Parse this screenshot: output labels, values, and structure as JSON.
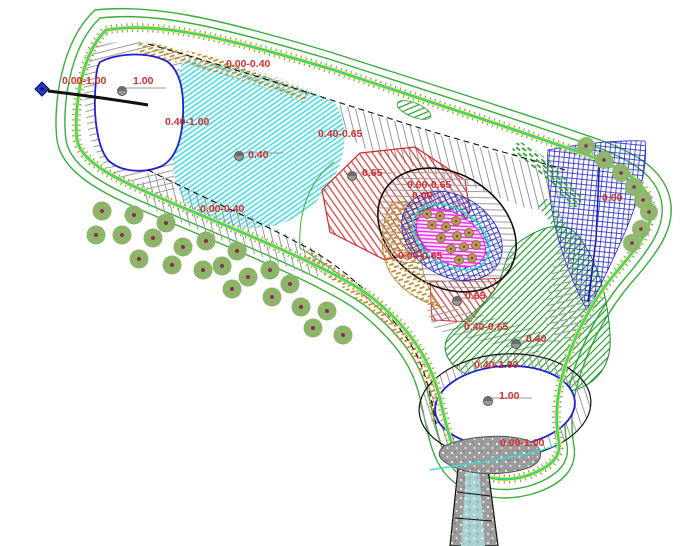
{
  "drawing": {
    "kind": "pond-landscape-plan",
    "colors": {
      "label_red": "#d23030",
      "boundary_green": "#3aae3a",
      "walk_yellow": "#f2ef3a",
      "walk_green": "#3cc43c",
      "walk_cyan": "#35dce0",
      "tick_grey": "#8a8a8a",
      "pond_blue": "#2020cc",
      "shore_black": "#111111",
      "cyan_hatch": "#3ed2da",
      "grey_hatch": "#9a9a9a",
      "red_hatch": "#d42a2a",
      "green_hatch": "#21a12e",
      "blue_cross": "#2329c9",
      "magenta_hatch": "#ea1dea",
      "tan_band": "#c08a28",
      "tree_fill": "#8db469",
      "tree_dot": "#8b2a52",
      "plant_fill": "#b89a58",
      "plant_edge": "#8a7340",
      "plant_dot": "#a22a4a",
      "marker_grey": "#999999",
      "benchmark_blue": "#2838c0",
      "pad_grey": "#9c9c9c",
      "stream_cyan": "#a9cfd2"
    },
    "labels": [
      {
        "text": "0.00-1.00",
        "x": 62,
        "y": 84
      },
      {
        "text": "1.00",
        "x": 133,
        "y": 84
      },
      {
        "text": "0.40-1.00",
        "x": 165,
        "y": 125
      },
      {
        "text": "0.00-0.40",
        "x": 226,
        "y": 67
      },
      {
        "text": "0.40",
        "x": 248,
        "y": 158
      },
      {
        "text": "0.40-0.65",
        "x": 318,
        "y": 137
      },
      {
        "text": "0.65",
        "x": 362,
        "y": 176
      },
      {
        "text": "0.00-0.65",
        "x": 407,
        "y": 188
      },
      {
        "text": "0.00",
        "x": 412,
        "y": 199
      },
      {
        "text": "0.00-0.65",
        "x": 398,
        "y": 259
      },
      {
        "text": "0.65",
        "x": 465,
        "y": 299
      },
      {
        "text": "0.40-0.65",
        "x": 464,
        "y": 330
      },
      {
        "text": "0.40",
        "x": 526,
        "y": 342
      },
      {
        "text": "0.40-1.00",
        "x": 474,
        "y": 368
      },
      {
        "text": "1.00",
        "x": 499,
        "y": 399
      },
      {
        "text": "0.00-1.00",
        "x": 500,
        "y": 446
      },
      {
        "text": "0.00",
        "x": 602,
        "y": 201
      },
      {
        "text": "0.00-0.40",
        "x": 200,
        "y": 212
      }
    ],
    "spot_markers": [
      {
        "x": 122,
        "y": 91
      },
      {
        "x": 239,
        "y": 156
      },
      {
        "x": 352,
        "y": 176
      },
      {
        "x": 457,
        "y": 301
      },
      {
        "x": 516,
        "y": 344
      },
      {
        "x": 488,
        "y": 401
      }
    ],
    "trees_left": [
      [
        102,
        211
      ],
      [
        96,
        235
      ],
      [
        122,
        235
      ],
      [
        134,
        215
      ],
      [
        153,
        238
      ],
      [
        166,
        223
      ],
      [
        139,
        259
      ],
      [
        172,
        265
      ],
      [
        183,
        247
      ],
      [
        203,
        270
      ],
      [
        206,
        241
      ],
      [
        222,
        266
      ],
      [
        237,
        251
      ],
      [
        232,
        289
      ],
      [
        248,
        277
      ],
      [
        270,
        270
      ],
      [
        272,
        297
      ],
      [
        290,
        284
      ],
      [
        301,
        307
      ],
      [
        313,
        328
      ],
      [
        327,
        311
      ],
      [
        343,
        335
      ]
    ],
    "trees_right": [
      [
        586,
        146
      ],
      [
        604,
        160
      ],
      [
        621,
        173
      ],
      [
        634,
        187
      ],
      [
        643,
        200
      ],
      [
        649,
        212
      ],
      [
        641,
        229
      ],
      [
        632,
        243
      ]
    ],
    "island_plants": [
      [
        427,
        214
      ],
      [
        440,
        216
      ],
      [
        432,
        225
      ],
      [
        446,
        227
      ],
      [
        456,
        221
      ],
      [
        441,
        238
      ],
      [
        457,
        236
      ],
      [
        469,
        233
      ],
      [
        451,
        249
      ],
      [
        464,
        247
      ],
      [
        476,
        245
      ],
      [
        459,
        260
      ],
      [
        472,
        258
      ]
    ],
    "benchmark": {
      "x": 42,
      "y": 89,
      "arrow_to_x": 148,
      "arrow_to_y": 105
    }
  }
}
